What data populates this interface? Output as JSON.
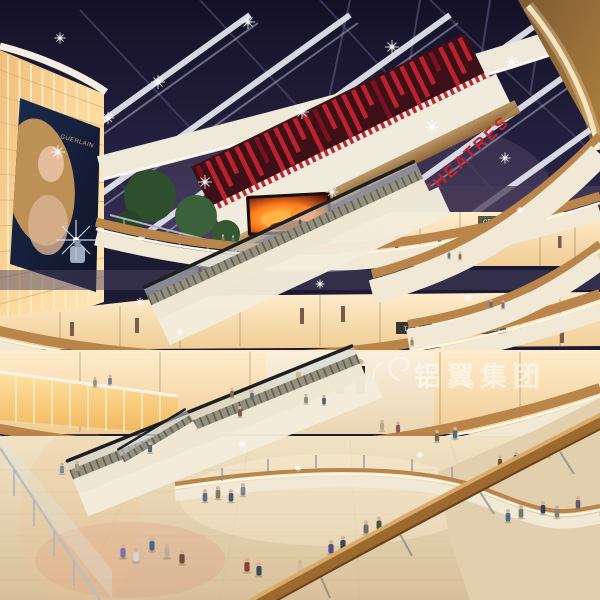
{
  "meta": {
    "subject": "architectural rendering of a multi-level shopping mall atrium at night",
    "features": [
      "dark glazed skylight with lit beams",
      "curved balcony fasciae",
      "escalators",
      "backlit panel wall with billboard",
      "crowds of shoppers"
    ]
  },
  "signs": {
    "theatres": "THEATRES",
    "store_upper": "CERRUTI 1881",
    "store_left": "TAI TAI",
    "store_right": "CERRUTI 1881"
  },
  "billboard": {
    "brand": "GUERLAIN"
  },
  "watermark": {
    "text": "铝翼集团"
  },
  "colors": {
    "sky_dark": "#151227",
    "sky_purple": "#6d5a78",
    "beam_white": "#e6e8f2",
    "theatre_red": "#c3242f",
    "fascia_cream": "#f1e8d6",
    "cove_glow": "#fff8e4",
    "wood": "#b9854b",
    "glow_wall": "#ffe8ba",
    "floor_beige": "#e6d5b5",
    "led_orange": "#ff8a2a"
  },
  "scene": {
    "people": [
      [
        123,
        557,
        1,
        "#7b6fae"
      ],
      [
        136,
        561,
        1,
        "#d9d6cf"
      ],
      [
        152,
        550,
        1,
        "#49698c"
      ],
      [
        167,
        557,
        1,
        "#b7b1a4"
      ],
      [
        182,
        563,
        1,
        "#6a4e3e"
      ],
      [
        247,
        571,
        1,
        "#8e3d3d"
      ],
      [
        259,
        575,
        1,
        "#3e4a5a"
      ],
      [
        300,
        573,
        1,
        "#c9bdab"
      ],
      [
        331,
        553,
        1,
        "#584a86"
      ],
      [
        343,
        549,
        1,
        "#38495f"
      ],
      [
        366,
        533,
        0.95,
        "#6c6c6c"
      ],
      [
        379,
        529,
        0.95,
        "#49573e"
      ],
      [
        205,
        501,
        0.9,
        "#5e6e85"
      ],
      [
        218,
        498,
        0.9,
        "#8b7964"
      ],
      [
        231,
        501,
        0.9,
        "#42587a"
      ],
      [
        243,
        495,
        0.9,
        "#798695"
      ],
      [
        437,
        441,
        0.85,
        "#7a6a58"
      ],
      [
        455,
        438,
        0.85,
        "#53677d"
      ],
      [
        508,
        521,
        0.9,
        "#4a6b8e"
      ],
      [
        521,
        517,
        0.9,
        "#6e7c69"
      ],
      [
        543,
        513,
        0.9,
        "#32425b"
      ],
      [
        557,
        517,
        0.9,
        "#898175"
      ],
      [
        578,
        508,
        0.9,
        "#5c5c6d"
      ],
      [
        500,
        466,
        0.8,
        "#69582f"
      ],
      [
        516,
        462,
        0.8,
        "#3f5a74"
      ],
      [
        548,
        456,
        0.8,
        "#7c4a4a"
      ],
      [
        95,
        386,
        0.7,
        "#9a8f7e"
      ],
      [
        110,
        384,
        0.7,
        "#6e7f95"
      ],
      [
        232,
        397,
        0.7,
        "#7f6a55"
      ],
      [
        252,
        399,
        0.7,
        "#566e84"
      ],
      [
        306,
        403,
        0.7,
        "#8a8276"
      ],
      [
        324,
        404,
        0.7,
        "#4f5d70"
      ],
      [
        62,
        473,
        0.8,
        "#7d8b99"
      ],
      [
        77,
        471,
        0.8,
        "#a49884"
      ],
      [
        449,
        258,
        0.55,
        "#6a7a8c"
      ],
      [
        460,
        259,
        0.55,
        "#8a6a5a"
      ],
      [
        491,
        307,
        0.6,
        "#5a6b7d"
      ],
      [
        503,
        308,
        0.6,
        "#7d6a88"
      ],
      [
        223,
        241,
        0.5,
        "#8a7a6a"
      ],
      [
        233,
        242,
        0.5,
        "#5c6c7e"
      ],
      [
        300,
        224,
        0.5,
        "#4a5a6a"
      ],
      [
        200,
        272,
        0.55,
        "#6a5a7a"
      ],
      [
        150,
        452,
        0.8,
        "#56687a"
      ],
      [
        240,
        416,
        0.75,
        "#7a5a4a"
      ],
      [
        412,
        345,
        0.6,
        "#9a8a5a"
      ],
      [
        382,
        430,
        0.8,
        "#b9a98a"
      ],
      [
        398,
        432,
        0.8,
        "#8a5a5a"
      ]
    ],
    "sparkles": [
      [
        58,
        152,
        1
      ],
      [
        158,
        82,
        1
      ],
      [
        248,
        22,
        1
      ],
      [
        205,
        182,
        1
      ],
      [
        302,
        112,
        1
      ],
      [
        392,
        47,
        1
      ],
      [
        332,
        192,
        0.9
      ],
      [
        432,
        127,
        1
      ],
      [
        512,
        62,
        1
      ],
      [
        60,
        38,
        0.8
      ],
      [
        108,
        118,
        0.9
      ],
      [
        505,
        158,
        0.8
      ],
      [
        140,
        302,
        0.65
      ],
      [
        320,
        284,
        0.65
      ],
      [
        468,
        298,
        0.6
      ],
      [
        242,
        444,
        0.55
      ],
      [
        420,
        455,
        0.55
      ],
      [
        298,
        468,
        0.5
      ],
      [
        520,
        210,
        0.5
      ],
      [
        180,
        332,
        0.5
      ]
    ]
  }
}
